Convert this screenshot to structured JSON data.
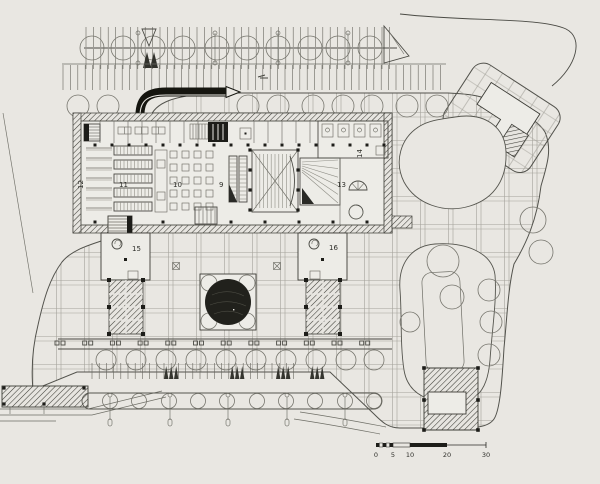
{
  "description": "Scanned black-and-white architectural site plan (ground floor) with parking rows, paved plaza grid, main building with numbered rooms, two stair towers with pergola wings, circular fountain, tree rows and a metric scale bar",
  "colors": {
    "paper": "#e9e7e2",
    "ink": "#2a2a26",
    "grid_line": "#a3a29a",
    "fountain_black": "#21211c"
  },
  "plan": {
    "room_labels": {
      "r9": "9",
      "r10": "10",
      "r11": "11",
      "r12": "12",
      "r13": "13",
      "r14": "14",
      "r15": "15",
      "r16": "16"
    }
  },
  "scale_bar": {
    "tick_labels": [
      "0",
      "5",
      "10",
      "20",
      "30"
    ]
  }
}
